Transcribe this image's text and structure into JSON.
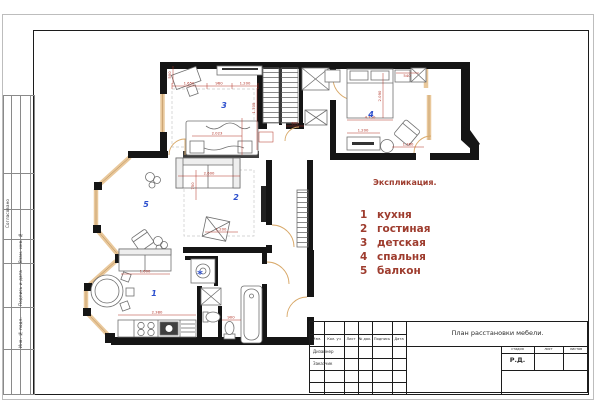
{
  "legend": {
    "title": "Экспликация.",
    "items": [
      {
        "num": "1",
        "name": "кухня"
      },
      {
        "num": "2",
        "name": "гостиная"
      },
      {
        "num": "3",
        "name": "детская"
      },
      {
        "num": "4",
        "name": "спальня"
      },
      {
        "num": "5",
        "name": "балкон"
      }
    ]
  },
  "title_block": {
    "title": "План расстановки мебели.",
    "columns": [
      "Изм.",
      "Кол. уч",
      "Лист",
      "№ док.",
      "Подпись",
      "Дата"
    ],
    "designer_label": "Дизайнер",
    "client_label": "Заказчик",
    "stage_header": [
      "стадия",
      "лист",
      "листов"
    ],
    "stage_value": "Р.Д."
  },
  "side_stamp": {
    "labels": [
      "Согласовано",
      "Взам. инв. №",
      "Подпись и дата",
      "Инв. № подл."
    ]
  },
  "plan": {
    "room_labels": [
      {
        "num": "3",
        "x": 224,
        "y": 108
      },
      {
        "num": "4",
        "x": 371,
        "y": 117
      },
      {
        "num": "2",
        "x": 236,
        "y": 200
      },
      {
        "num": "5",
        "x": 146,
        "y": 207
      },
      {
        "num": "1",
        "x": 154,
        "y": 296
      }
    ],
    "marks": [
      {
        "symbol": "*",
        "x": 200,
        "y": 278
      }
    ],
    "dimensions": [
      {
        "v": "1.650",
        "x": 189,
        "y": 84.5
      },
      {
        "v": "960",
        "x": 219,
        "y": 84.5
      },
      {
        "v": "1.200",
        "x": 245,
        "y": 84.5
      },
      {
        "v": "500",
        "x": 171,
        "y": 75,
        "rot": true
      },
      {
        "v": "1.705",
        "x": 255,
        "y": 108,
        "rot": true
      },
      {
        "v": "2.023",
        "x": 217,
        "y": 134.5
      },
      {
        "v": "2.600",
        "x": 209,
        "y": 174.5
      },
      {
        "v": "750",
        "x": 194,
        "y": 186,
        "rot": true
      },
      {
        "v": "1.200",
        "x": 221,
        "y": 230.5
      },
      {
        "v": "2.090",
        "x": 381,
        "y": 96,
        "rot": true
      },
      {
        "v": "4.750",
        "x": 370,
        "y": 118.5
      },
      {
        "v": "1.200",
        "x": 363,
        "y": 131.5
      },
      {
        "v": "1.380",
        "x": 408,
        "y": 145.5
      },
      {
        "v": "540",
        "x": 407,
        "y": 77
      },
      {
        "v": "600",
        "x": 295,
        "y": 124.5
      },
      {
        "v": "1.600",
        "x": 145,
        "y": 272.5
      },
      {
        "v": "2.380",
        "x": 157,
        "y": 313.5
      },
      {
        "v": "900",
        "x": 231,
        "y": 318.5
      }
    ],
    "colors": {
      "wall": "#151515",
      "window": "#e9c89b",
      "dimension": "#b23226",
      "room_number": "#2b4ecd",
      "legend_text": "#9e3c2e",
      "door_arc": "#d8a868"
    }
  }
}
